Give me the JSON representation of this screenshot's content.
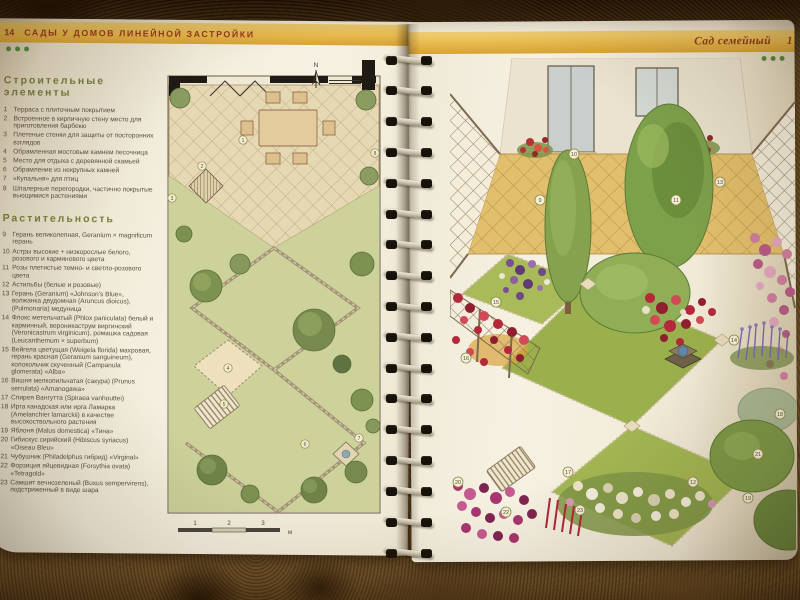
{
  "left": {
    "page_number": "14",
    "header": "САДЫ У ДОМОВ ЛИНЕЙНОЙ ЗАСТРОЙКИ",
    "building": {
      "title": "Строительные элементы",
      "items": [
        {
          "n": "1",
          "t": "Терраса с плиточным покрытием"
        },
        {
          "n": "2",
          "t": "Встроенное в кирпичную стену место для приготовления барбекю"
        },
        {
          "n": "3",
          "t": "Плетеные стенки для защиты от посторонних взглядов"
        },
        {
          "n": "4",
          "t": "Обрамленная мостовым камнем песочница"
        },
        {
          "n": "5",
          "t": "Место для отдыха с деревянной скамьей"
        },
        {
          "n": "6",
          "t": "Обрамление из некрупных камней"
        },
        {
          "n": "7",
          "t": "«Купальня» для птиц"
        },
        {
          "n": "8",
          "t": "Шпалерные перегородки, частично покрытые вьющимися растениями"
        }
      ]
    },
    "plants": {
      "title": "Растительность",
      "items": [
        {
          "n": "9",
          "t": "Герань великолепная, Geranium × magnificum герань"
        },
        {
          "n": "10",
          "t": "Астры высокие + низкорослые белого, розового и карминового цвета"
        },
        {
          "n": "11",
          "t": "Розы плетистые темно- и светло-розового цвета"
        },
        {
          "n": "12",
          "t": "Астильбы (белые и розовые)"
        },
        {
          "n": "13",
          "t": "Герань (Geranium) «Johnson's Blue», волжанка двудомная (Aruncus dioicus), (Pulmonaria) медуница"
        },
        {
          "n": "14",
          "t": "Флокс метельчатый (Phlox paniculata) белый и карминный, вероникаструм виргинский (Veronicastrum virginicum), ромашка садовая (Leucanthemum × superbum)"
        },
        {
          "n": "15",
          "t": "Вейгела цветущая (Weigela florida) махровая, герань красная (Geranium sanguineum), колокольчик скученный (Campanula glomerata) «Alba»"
        },
        {
          "n": "16",
          "t": "Вишня мелкопильчатая (сакура) (Prunus serrulata) «Amanogawa»"
        },
        {
          "n": "17",
          "t": "Спирея Вангутта (Spiraea vanhouttei)"
        },
        {
          "n": "18",
          "t": "Ирга канадская или ирга Ламарка (Amelanchier lamarckii) в качестве высокоствольного растения"
        },
        {
          "n": "19",
          "t": "Яблоня (Malus domestica) «Тина»"
        },
        {
          "n": "20",
          "t": "Гибискус сирийский (Hibiscus syriacus) «Oiseau Bleu»"
        },
        {
          "n": "21",
          "t": "Чубушник (Philadelphus гибрид) «Virginal»"
        },
        {
          "n": "22",
          "t": "Форзиция яйцевидная (Forsythia ovata) «Tetragold»"
        },
        {
          "n": "23",
          "t": "Самшит вечнозеленый (Buxus sempervirens), подстриженный в виде шара"
        }
      ]
    },
    "plan": {
      "north": "N",
      "scale": [
        "1",
        "2",
        "3",
        "м"
      ],
      "markers": [
        "1",
        "2",
        "3",
        "4",
        "5",
        "6",
        "7",
        "8"
      ]
    }
  },
  "right": {
    "header": "Сад семейный",
    "page_number_visible": "1",
    "markers": [
      "9",
      "10",
      "11",
      "12",
      "13",
      "14",
      "15",
      "16",
      "17",
      "18",
      "19",
      "20",
      "21",
      "22",
      "23"
    ]
  },
  "colors": {
    "band_yellow": "#e6b84c",
    "header_text": "#93351e",
    "heading_olive": "#76803e",
    "page_cream": "#f1ebdb",
    "lawn_green": "#9cb14e",
    "dots_green": "#5c8a3f"
  }
}
